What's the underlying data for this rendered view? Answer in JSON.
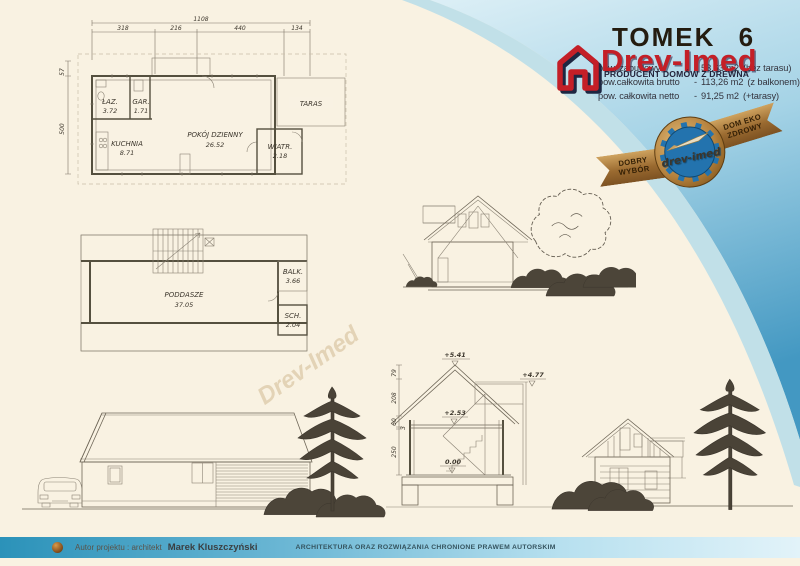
{
  "header": {
    "title": "TOMEK 6",
    "brand": "Drev-Imed",
    "brand_tagline": "PRODUCENT DOMÓW Z DREWNA",
    "specs": [
      {
        "label": "pow. zabudowy",
        "dash": "-",
        "value": "53,63 m2",
        "note": "(bez tarasu)"
      },
      {
        "label": "pow.całkowita brutto",
        "dash": "-",
        "value": "113,26 m2",
        "note": "(z balkonem)"
      },
      {
        "label": "pow. całkowita netto",
        "dash": "-",
        "value": "91,25 m2",
        "note": "(+tarasy)"
      }
    ]
  },
  "badge": {
    "ribbon_left": "DOBRY WYBÓR",
    "seal": "drev-imed",
    "ribbon_right": "DOM EKO ZDROWY"
  },
  "ground_plan": {
    "dims": {
      "total": "1108",
      "segments": [
        "318",
        "216",
        "440",
        "134"
      ],
      "left_upper": "57",
      "left_lower": "500"
    },
    "rooms": {
      "laz": {
        "name": "ŁAZ.",
        "area": "3.72"
      },
      "gar": {
        "name": "GAR.",
        "area": "1.71"
      },
      "kuchnia": {
        "name": "KUCHNIA",
        "area": "8.71"
      },
      "pokoj": {
        "name": "POKÓJ DZIENNY",
        "area": "26.52"
      },
      "wiatr": {
        "name": "WIATR.",
        "area": "2.18"
      },
      "taras": {
        "name": "TARAS"
      }
    }
  },
  "attic_plan": {
    "rooms": {
      "poddasze": {
        "name": "PODDASZE",
        "area": "37.05"
      },
      "balk": {
        "name": "BALK.",
        "area": "3.66"
      },
      "sch": {
        "name": "SCH.",
        "area": "2.04"
      }
    }
  },
  "section": {
    "levels": {
      "ridge": "+5.41",
      "balcony": "+4.77",
      "attic_floor": "+2.53",
      "ground_floor": "0.00"
    },
    "dims": [
      "79",
      "208",
      "60",
      "3",
      "250"
    ]
  },
  "footer": {
    "author_label": "Autor projektu : architekt",
    "author_name": "Marek Kluszczyński",
    "copyright": "ARCHITEKTURA ORAZ ROZWIĄZANIA CHRONIONE PRAWEM AUTORSKIM"
  },
  "watermark": "Drev-Imed",
  "colors": {
    "background_cream": "#f9f2e2",
    "swoosh_blue": "#4398c2",
    "accent_red": "#c41f27",
    "badge_gold": "#9a6a30",
    "seal_blue": "#2373ae",
    "footer_blue": "#2b92b9"
  }
}
